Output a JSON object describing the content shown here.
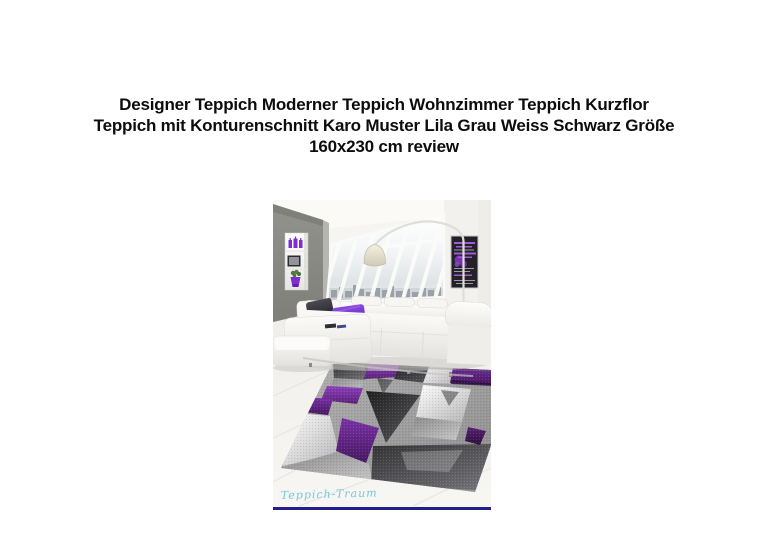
{
  "title": {
    "lines": [
      "Designer Teppich Moderner Teppich Wohnzimmer Teppich Kurzflor",
      "Teppich mit Konturenschnitt Karo Muster Lila Grau Weiss Schwarz Größe",
      "160x230 cm review"
    ]
  },
  "photo": {
    "watermark": "Teppich-Traum"
  },
  "palette": {
    "title_text": "#0d0d0d",
    "underline_navy": "#221e8c",
    "watermark_cyan": "#70c9de",
    "rug_purple": "#6d2a8f",
    "rug_purple_dark": "#3c1452",
    "rug_grey_dark": "#323234",
    "rug_grey_light": "#dcdcdc",
    "wall_grey": "#8d8d86",
    "pillow_purple": "#7636c8",
    "sofa_white": "#f6f5f2"
  }
}
